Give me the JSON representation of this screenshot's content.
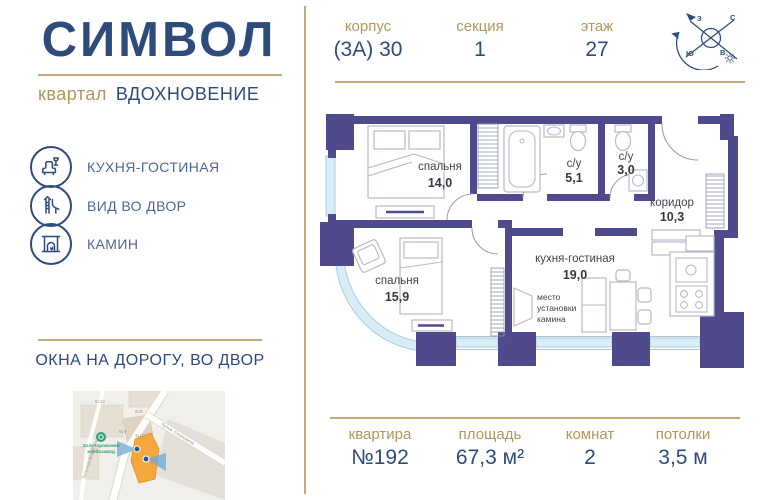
{
  "brand": {
    "logo": "СИМВОЛ",
    "quarter_label": "квартал",
    "quarter_name": "ВДОХНОВЕНИЕ"
  },
  "header": {
    "stats": [
      {
        "label": "корпус",
        "value": "(3А) 30"
      },
      {
        "label": "секция",
        "value": "1"
      },
      {
        "label": "этаж",
        "value": "27"
      }
    ],
    "compass": {
      "n": "С",
      "s": "Ю",
      "w": "З",
      "e": "В"
    }
  },
  "features": {
    "items": [
      {
        "label": "КУХНЯ-ГОСТИНАЯ"
      },
      {
        "label": "ВИД ВО ДВОР"
      },
      {
        "label": "КАМИН"
      }
    ]
  },
  "windows_note": "ОКНА НА ДОРОГУ, ВО ДВОР",
  "map": {
    "poi_line1": "Золоторожский",
    "poi_line2": "хлебозавод",
    "street_1": "Золоторожский Вал",
    "street_2": "бульв. Сенкевича",
    "buildings": [
      "6с12",
      "6с8",
      "6с9",
      "11с2"
    ]
  },
  "plan": {
    "rooms": {
      "bedroom1": {
        "name": "спальня",
        "area": "14,0"
      },
      "bath1": {
        "name": "с/у",
        "area": "5,1"
      },
      "bath2": {
        "name": "с/у",
        "area": "3,0"
      },
      "corridor": {
        "name": "коридор",
        "area": "10,3"
      },
      "kitchen": {
        "name": "кухня-гостиная",
        "area": "19,0"
      },
      "bedroom2": {
        "name": "спальня",
        "area": "15,9"
      }
    },
    "fireplace_note": {
      "l1": "место",
      "l2": "установки",
      "l3": "камина"
    }
  },
  "footer": {
    "stats": [
      {
        "label": "квартира",
        "value": "№192"
      },
      {
        "label": "площадь",
        "value": "67,3 м²"
      },
      {
        "label": "комнат",
        "value": "2"
      },
      {
        "label": "потолки",
        "value": "3,5 м"
      }
    ]
  },
  "colors": {
    "navy": "#2D4B7B",
    "gold": "#B3965A",
    "gold_line": "#C8A878",
    "wall": "#4E4A8C",
    "window": "#D9EDF6",
    "map_highlight": "#F4A73C"
  }
}
